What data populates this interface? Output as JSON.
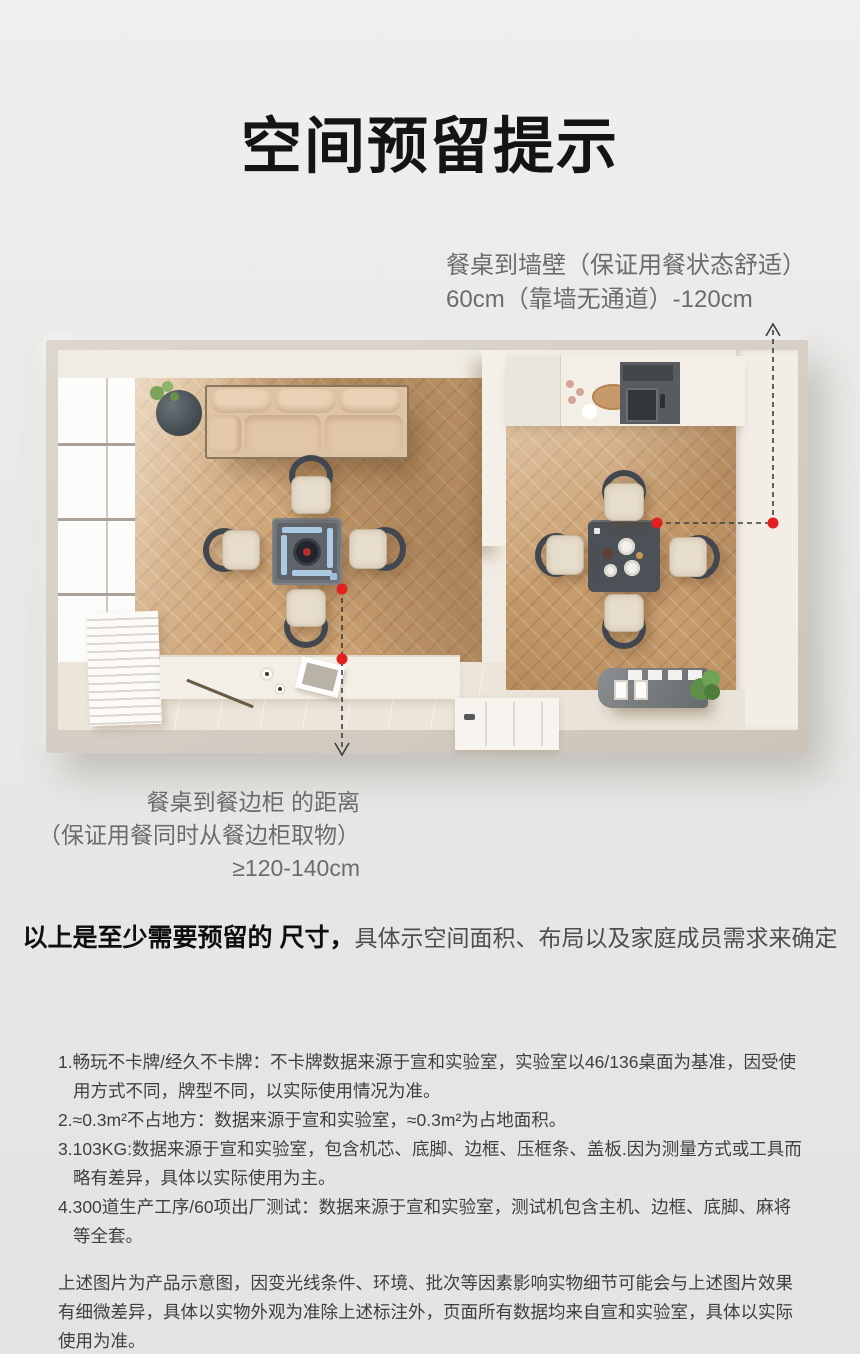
{
  "page": {
    "title": "空间预留提示"
  },
  "annotations": {
    "wall": {
      "line1": "餐桌到墙壁（保证用餐状态舒适）",
      "line2": "60cm（靠墙无通道）-120cm"
    },
    "sideboard": {
      "line1": "餐桌到餐边柜 的距离",
      "line2": "（保证用餐同时从餐边柜取物）",
      "line3": "≥120-140cm"
    }
  },
  "statement": {
    "bold": "以上是至少需要预留的 尺寸，",
    "rest": "具体示空间面积、布局以及家庭成员需求来确定"
  },
  "disclaimers": {
    "items": [
      "1.畅玩不卡牌/经久不卡牌：不卡牌数据来源于宣和实验室，实验室以46/136桌面为基准，因受使用方式不同，牌型不同，以实际使用情况为准。",
      "2.≈0.3m²不占地方：数据来源于宣和实验室，≈0.3m²为占地面积。",
      "3.103KG:数据来源于宣和实验室，包含机芯、底脚、边框、压框条、盖板.因为测量方式或工具而略有差异，具体以实际使用为主。",
      "4.300道生产工序/60项出厂测试：数据来源于宣和实验室，测试机包含主机、边框、底脚、麻将等全套。"
    ],
    "paragraph": "上述图片为产品示意图，因变光线条件、环境、批次等因素影响实物细节可能会与上述图片效果有细微差异，具体以实物外观为准除上述标注外，页面所有数据均来自宣和实验室，具体以实际使用为准。",
    "quote": "\"本产品为家庭娱乐器械，禁止用于非法活动\""
  },
  "colors": {
    "accent_red": "#e0211f",
    "measure_line": "#3d3d3d",
    "title_black": "#141414",
    "annotation_gray": "#6c6c6c"
  }
}
